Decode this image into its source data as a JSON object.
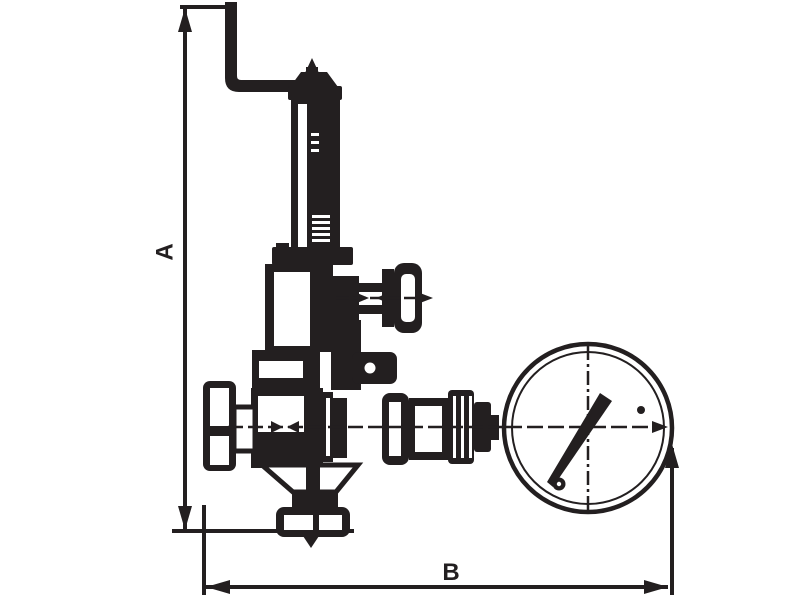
{
  "drawing": {
    "kind": "technical-line-drawing",
    "labels": {
      "dim_vertical": "A",
      "dim_horizontal": "B"
    },
    "colors": {
      "ink": "#231f20",
      "background": "#ffffff"
    },
    "parts": [
      "lever-handle",
      "adjusting-cap",
      "spring-housing",
      "bonnet",
      "tee-valve",
      "tee-handle",
      "handwheel",
      "valve-body",
      "outlet-fitting-train",
      "pressure-gauge",
      "gauge-needle",
      "bottom-coupling",
      "dimension-a",
      "dimension-b"
    ]
  }
}
